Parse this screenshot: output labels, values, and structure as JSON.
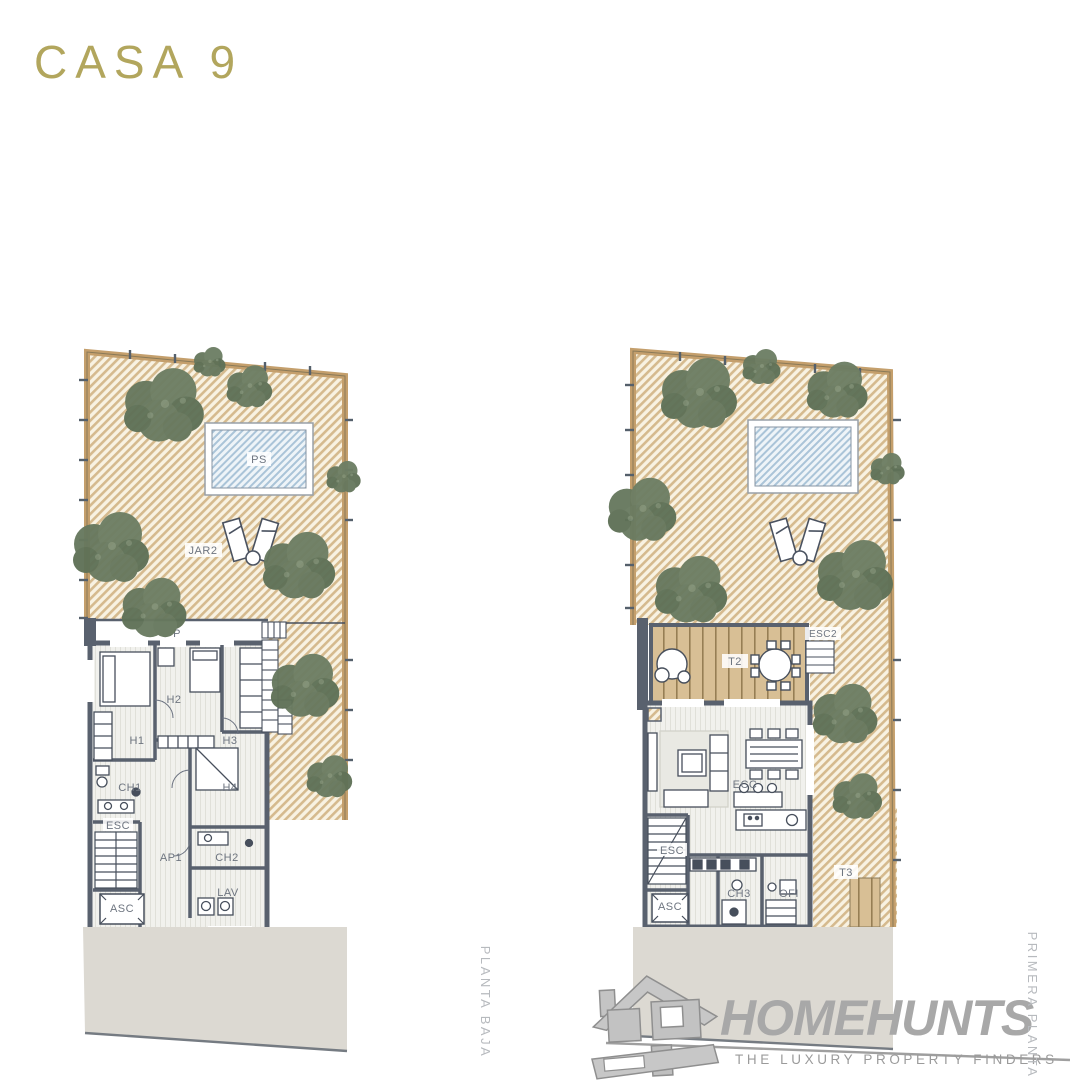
{
  "title": "CASA 9",
  "plans": {
    "left": {
      "floor_name": "PLANTA BAJA",
      "labels": {
        "pool": "PS",
        "garden": "JAR2",
        "porch": "P",
        "h1": "H1",
        "h2": "H2",
        "h3": "H3",
        "h4": "H4",
        "ch1": "CH1",
        "ch2": "CH2",
        "esc": "ESC",
        "ap1": "AP1",
        "lav": "LAV",
        "asc": "ASC"
      }
    },
    "right": {
      "floor_name": "PRIMERA PLANTA",
      "labels": {
        "t2": "T2",
        "esc2": "ESC2",
        "ecc": "ECC",
        "esc": "ESC",
        "asc": "ASC",
        "ch3": "CH3",
        "ofi": "OFI",
        "t3": "T3"
      }
    }
  },
  "logo": {
    "brand": "HOMEHUNTS",
    "tagline": "THE LUXURY PROPERTY FINDERS"
  },
  "colors": {
    "title_gold": "#b2a65d",
    "tree_green": "#68795f",
    "garden_stripe": "#d5ba8e",
    "pool_blue": "#aac4d8",
    "wall_slate": "#59616e",
    "deck_tan": "#d8bf95",
    "platform_gray": "#dcd9d2",
    "logo_gray": "#a8a8a8"
  }
}
